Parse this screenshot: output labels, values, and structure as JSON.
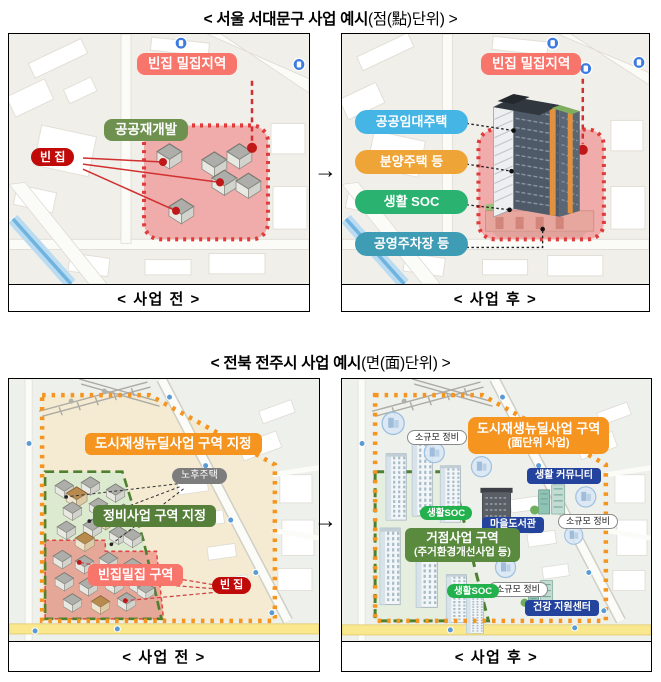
{
  "arrow_glyph": "→",
  "section1": {
    "title_main": "< 서울 서대문구 사업 예시",
    "title_paren": "(점(點)단위) >",
    "before": {
      "caption": "< 사업 전 >",
      "dense_area_label": "빈집 밀집지역",
      "redevelopment_label": "공공재개발",
      "vacant_house_label": "빈 집"
    },
    "after": {
      "caption": "< 사업 후 >",
      "dense_area_label": "빈집 밀집지역",
      "legend": [
        {
          "label": "공공임대주택",
          "color": "#45B5E5"
        },
        {
          "label": "분양주택 등",
          "color": "#EEA437"
        },
        {
          "label": "생활 SOC",
          "color": "#29B270"
        },
        {
          "label": "공영주차장 등",
          "color": "#3F9CB5"
        }
      ]
    }
  },
  "section2": {
    "title_main": "< 전북 전주시 사업 예시",
    "title_paren": "(면(面)단위) >",
    "before": {
      "caption": "< 사업 전 >",
      "newdeal_zone_label": "도시재생뉴딜사업 구역 지정",
      "old_housing_label": "노후주택",
      "maintenance_zone_label": "정비사업 구역 지정",
      "vacant_dense_label": "빈집밀집 구역",
      "vacant_house_label": "빈 집"
    },
    "after": {
      "caption": "< 사업 후 >",
      "newdeal_zone_line1": "도시재생뉴딜사업 구역",
      "newdeal_zone_line2": "(面단위 사업)",
      "small_scale_label": "소규모 정비",
      "living_community_label": "생활 커뮤니티",
      "living_soc_label": "생활SOC",
      "village_library_label": "마을도서관",
      "hub_zone_line1": "거점사업 구역",
      "hub_zone_line2": "(주거환경개선사업 등)",
      "health_center_label": "건강 지원센터"
    }
  },
  "colors": {
    "zone_orange": "#F5941E",
    "zone_red_fill": "#F06A6A",
    "zone_red_border": "#E03A3A",
    "zone_green_border": "#4E8030",
    "zone_green_fill": "#DCEAD0",
    "label_salmon": "#F8756C",
    "label_olive": "#6E9150",
    "label_dark_red": "#C00A0A",
    "label_gray": "#7D7D7D",
    "label_green": "#567F3A",
    "label_navy": "#24439C",
    "label_soc_green": "#22B14C"
  }
}
